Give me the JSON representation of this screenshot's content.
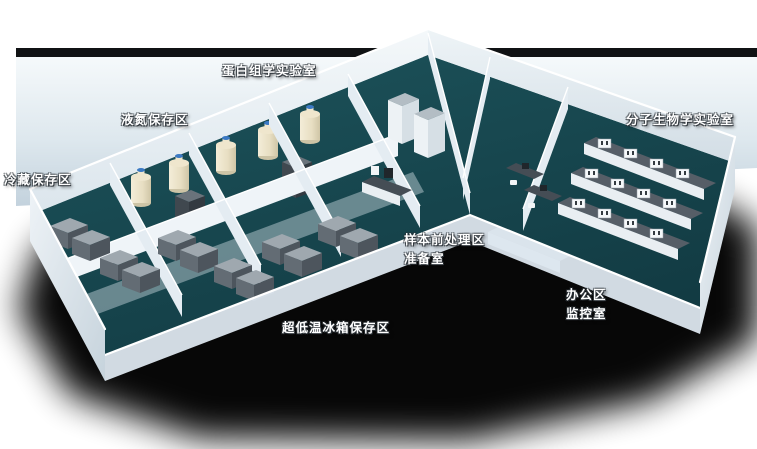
{
  "scene": {
    "type": "3d-isometric-lab-floorplan",
    "description_labels_only": true
  },
  "labels": [
    {
      "id": "proteomics-lab",
      "text": "蛋白组学实验室",
      "x": 222,
      "y": 60
    },
    {
      "id": "liquid-nitrogen-storage",
      "text": "液氮保存区",
      "x": 121,
      "y": 109
    },
    {
      "id": "cold-storage",
      "text": "冷藏保存区",
      "x": 4,
      "y": 169
    },
    {
      "id": "molecular-biology-lab",
      "text": "分子生物学实验室",
      "x": 626,
      "y": 109
    },
    {
      "id": "sample-pretreatment-area",
      "text": "样本前处理区",
      "x": 404,
      "y": 229
    },
    {
      "id": "preparation-room",
      "text": "准备室",
      "x": 404,
      "y": 248
    },
    {
      "id": "office-area",
      "text": "办公区",
      "x": 566,
      "y": 284
    },
    {
      "id": "monitoring-room",
      "text": "监控室",
      "x": 566,
      "y": 303
    },
    {
      "id": "ult-freezer-storage",
      "text": "超低温冰箱保存区",
      "x": 282,
      "y": 317
    }
  ],
  "colors": {
    "page_bg": "#ffffff",
    "label_text": "#ffffff",
    "shadow": "#000000",
    "backdrop_edge": "#101214",
    "floor": "#17454e",
    "wall": "#e9eff4",
    "tank_cap": "#3b79c3",
    "freezer": "#636c74",
    "bench_top": "#565e67"
  }
}
